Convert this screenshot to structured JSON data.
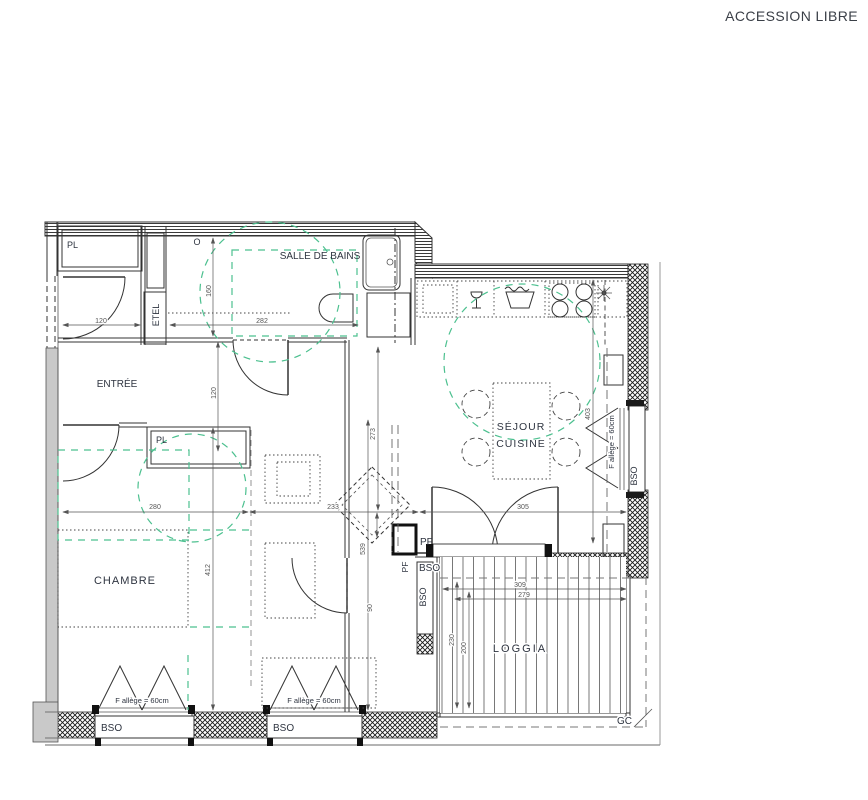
{
  "title": "ACCESSION LIBRE",
  "rooms": {
    "salle_de_bains": "SALLE DE BAINS",
    "entree": "ENTRÉE",
    "chambre": "CHAMBRE",
    "sejour": "SÉJOUR",
    "cuisine": "CUISINE",
    "loggia": "LOGGIA"
  },
  "features": {
    "pl_top": "PL",
    "pl_entree": "PL",
    "etel": "ETEL",
    "o_marker": "O",
    "pf_door": "PF",
    "pf_window": "PF",
    "bso_door": "BSO",
    "bso_loggia_side": "BSO",
    "bso_right_window": "BSO",
    "bso_window_1": "BSO",
    "bso_window_2": "BSO",
    "gc": "GC",
    "allege_window_1": "F allège = 60cm",
    "allege_window_2": "F allège = 60cm",
    "allege_right_window": "F allège = 60cm"
  },
  "dimensions": {
    "entry_width": "120",
    "bath_width": "282",
    "bath_depth": "160",
    "hall_width": "120",
    "chambre_width": "280",
    "middle_width": "233",
    "sejour_width": "305",
    "sejour_depth_left": "273",
    "room_height": "539",
    "chambre_depth": "412",
    "sejour_depth_right": "403",
    "door_width": "90",
    "loggia_width_outer": "309",
    "loggia_width_inner": "279",
    "loggia_depth_outer": "230",
    "loggia_depth_inner": "200"
  },
  "colors": {
    "line": "#333333",
    "accessibility_green": "#4cc08f",
    "wall_gray": "#c9c9c9",
    "dim_text": "#555555"
  }
}
